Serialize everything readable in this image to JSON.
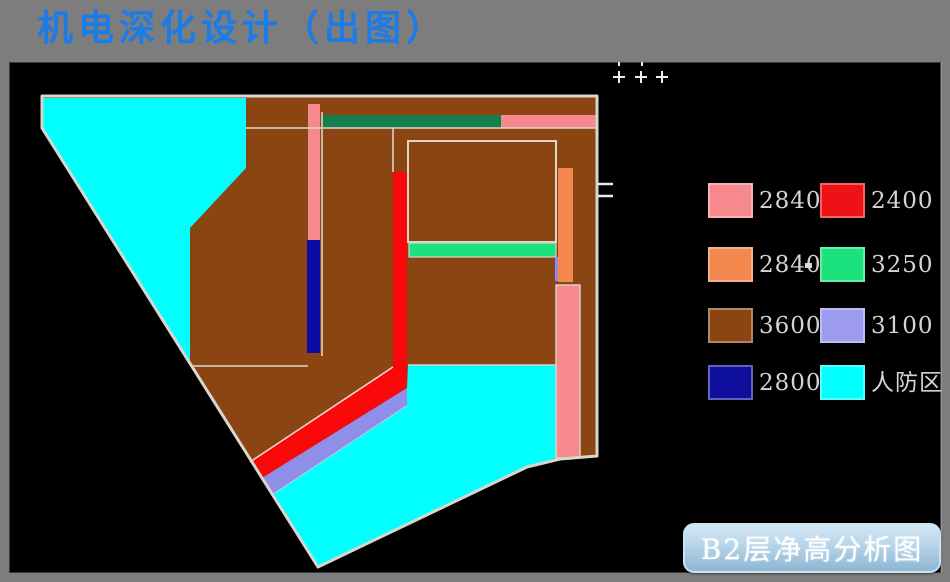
{
  "header": {
    "title": "机电深化设计（出图）",
    "color": "#1A7CE8"
  },
  "canvas": {
    "background": "#000000",
    "outline_color": "#D9D6CE"
  },
  "legend": {
    "dash": "",
    "items": [
      {
        "label": "2840",
        "color": "#F5898D"
      },
      {
        "label": "2400",
        "color": "#EE1216"
      },
      {
        "label": "2840",
        "color": "#F2884E"
      },
      {
        "label": "3250",
        "color": "#1CE27D"
      },
      {
        "label": "3600",
        "color": "#8A4513"
      },
      {
        "label": "3100",
        "color": "#9C9BF0"
      },
      {
        "label": "2800",
        "color": "#0E0E9C"
      },
      {
        "label": "人防区",
        "color": "#00FFFF"
      }
    ]
  },
  "caption": {
    "text": "B2层净高分析图"
  },
  "plan_colors": {
    "brown": "#8A4513",
    "cyan": "#00FFFF",
    "dark_green": "#147F4B",
    "pink": "#F5898D",
    "red": "#F80808",
    "orange": "#F2884E",
    "spring_green": "#1CE27D",
    "periwinkle": "#8F8FEA",
    "navy": "#0B0BA5",
    "boundary_white": "#D9D6CE"
  }
}
